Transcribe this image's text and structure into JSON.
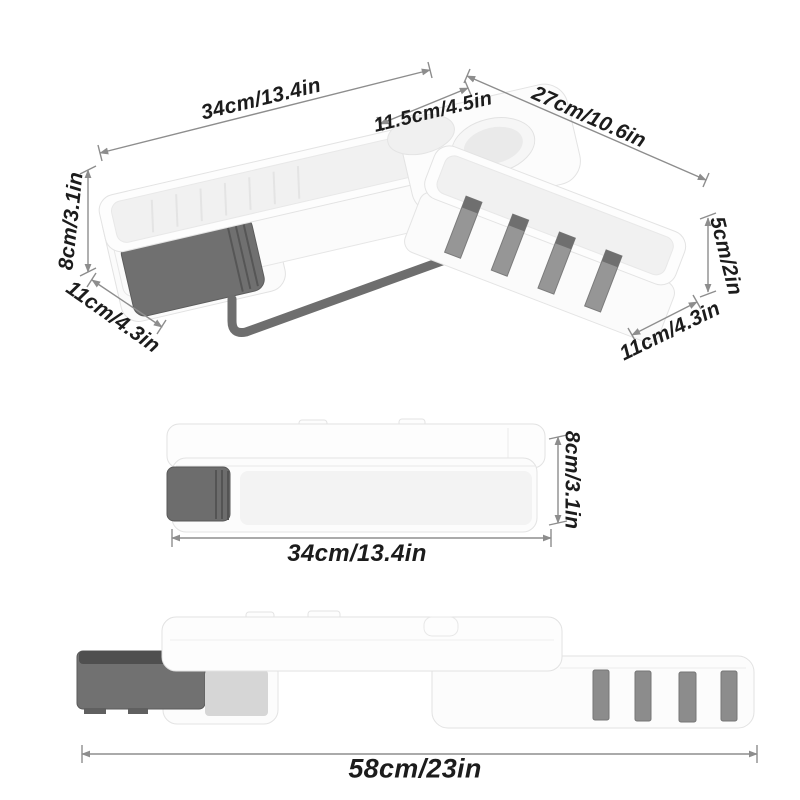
{
  "page": {
    "background": "#ffffff"
  },
  "product": {
    "colors": {
      "body_white": "#fdfdfd",
      "tray_inner": "#f1f1f1",
      "outline": "#e3e3e3",
      "drawer_gray": "#707070",
      "drawer_dark": "#4f4f4f",
      "hook_gray": "#969696",
      "towel_bar": "#6e6e6e",
      "bracket_window": "#d6d6d6",
      "dimension_line": "#8d8d8d",
      "dimension_text": "#1c1c1c"
    }
  },
  "views": {
    "isometric": {
      "dimensions": [
        {
          "id": "top-length",
          "label": "34cm/13.4in"
        },
        {
          "id": "cup-width",
          "label": "11.5cm/4.5in"
        },
        {
          "id": "side-length",
          "label": "27cm/10.6in"
        },
        {
          "id": "height",
          "label": "8cm/3.1in"
        },
        {
          "id": "depth-left",
          "label": "11cm/4.3in"
        },
        {
          "id": "side-height",
          "label": "5cm/2in"
        },
        {
          "id": "depth-right",
          "label": "11cm/4.3in"
        }
      ]
    },
    "front": {
      "dimensions": [
        {
          "id": "height",
          "label": "8cm/3.1in"
        },
        {
          "id": "length",
          "label": "34cm/13.4in"
        }
      ]
    },
    "extended": {
      "dimensions": [
        {
          "id": "total-length",
          "label": "58cm/23in"
        }
      ]
    }
  }
}
